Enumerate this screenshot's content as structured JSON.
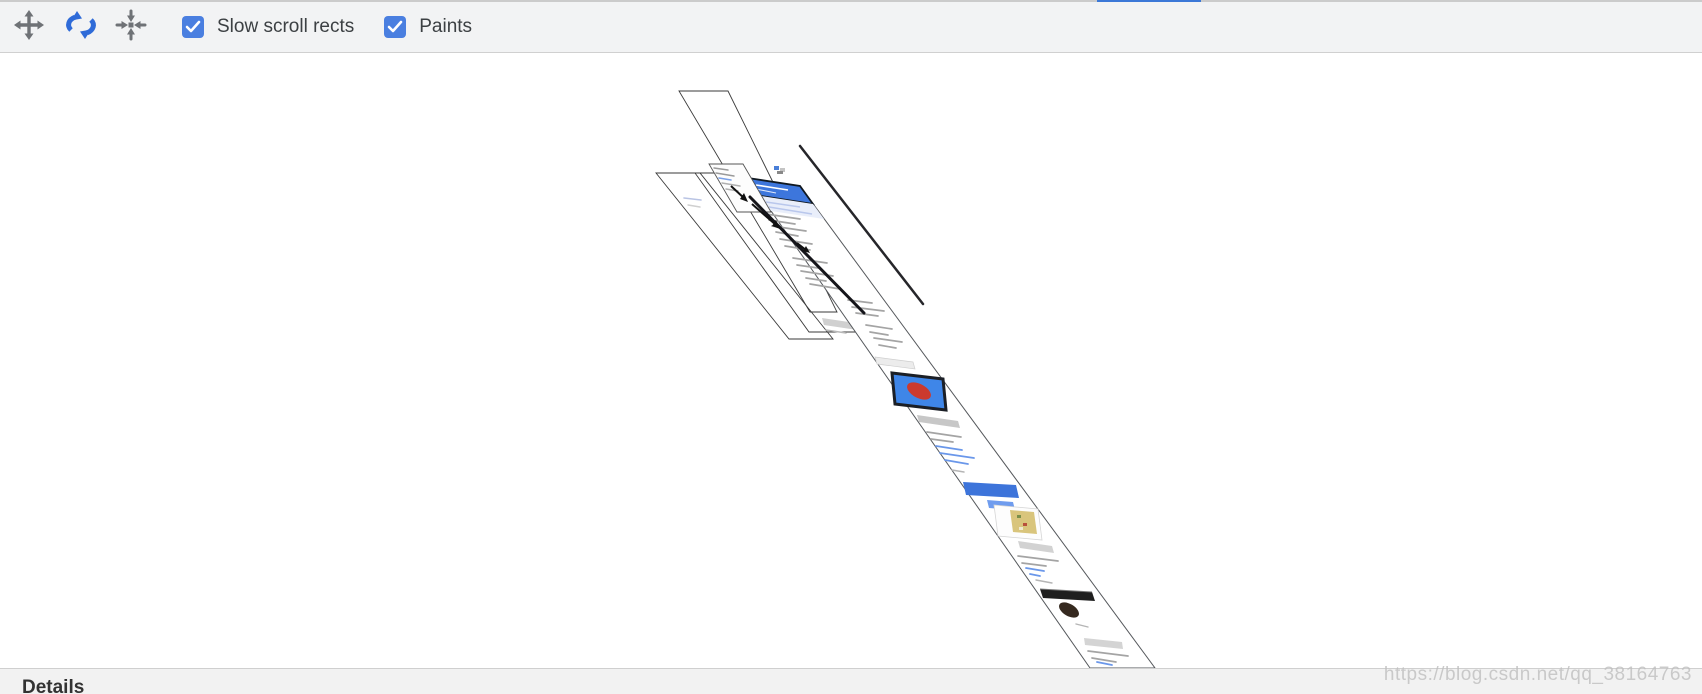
{
  "window": {
    "tab_indicator_color": "#3b78d7"
  },
  "toolbar": {
    "icons": [
      {
        "name": "pan",
        "tooltip": "Pan mode",
        "active": false,
        "color": "#6f7276"
      },
      {
        "name": "rotate",
        "tooltip": "Rotate mode",
        "active": true,
        "color": "#2f6bd8"
      },
      {
        "name": "center",
        "tooltip": "Reset view",
        "active": false,
        "color": "#6f7276"
      }
    ],
    "checkboxes": [
      {
        "label": "Slow scroll rects",
        "checked": true
      },
      {
        "label": "Paints",
        "checked": true
      }
    ],
    "checkbox_color": "#4a7fe0"
  },
  "scene": {
    "description": "3D rotated view of page compositing layers",
    "layer_outline_color": "#3a3a3a",
    "document_strip": {
      "background": "#ffffff",
      "header_color": "#3d76dc",
      "media_block": {
        "fill": "#3f86e8",
        "ellipse": "#cb3a2e",
        "border": "#1b1f26"
      },
      "banner_color": "#3d74da",
      "button_color": "#6f9cee",
      "thumb_color": "#d9c57c",
      "footer_color": "#1f1f1f",
      "link_color": "#6a97ea",
      "text_line_color": "#a4a4a4"
    },
    "edge_on_layer_color": "#1a1a1e"
  },
  "details_panel": {
    "title": "Details"
  },
  "watermark": {
    "text": "https://blog.csdn.net/qq_38164763"
  }
}
